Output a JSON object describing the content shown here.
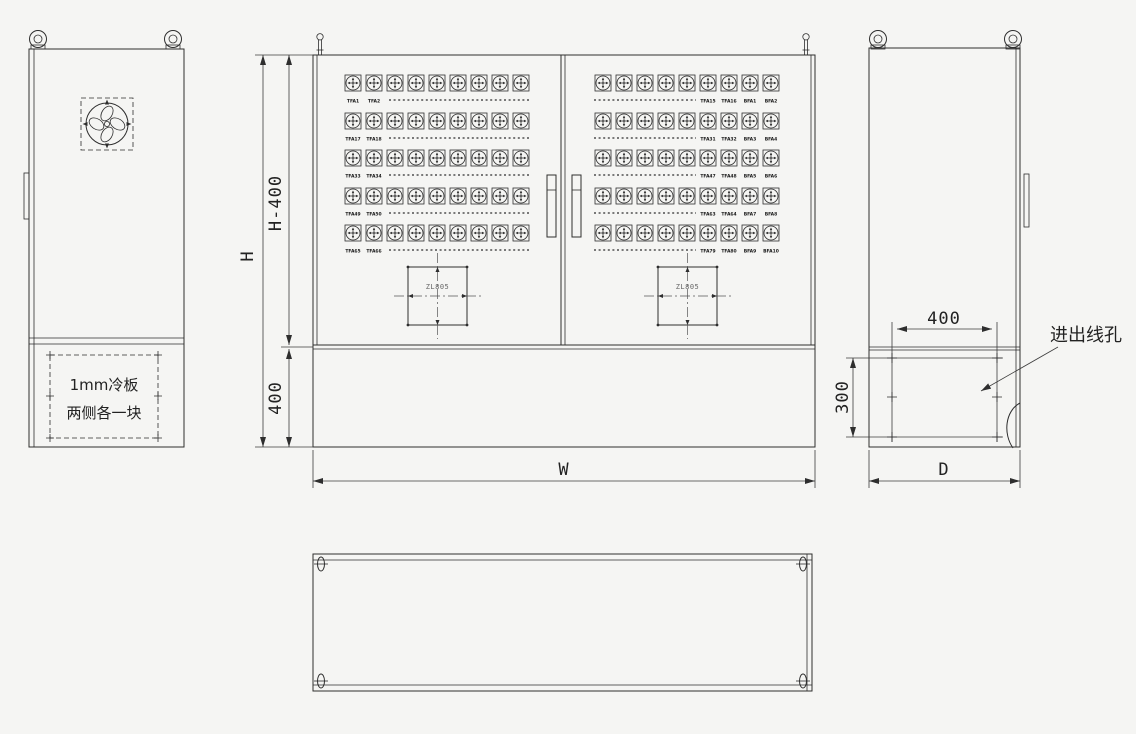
{
  "colors": {
    "background": "#f5f5f3",
    "line": "#2e2e2e",
    "dim_line": "#3c3c3c",
    "muted_text": "#666666"
  },
  "left_view": {
    "cold_plate_note": [
      "1mm冷板",
      "两侧各一块"
    ]
  },
  "front_view": {
    "left_door_rows": [
      [
        "TFA1",
        "TFA2"
      ],
      [
        "TFA17",
        "TFA18"
      ],
      [
        "TFA33",
        "TFA34"
      ],
      [
        "TFA49",
        "TFA50"
      ],
      [
        "TFA65",
        "TFA66"
      ]
    ],
    "right_door_rows": [
      [
        "TFA15",
        "TFA16",
        "BFA1",
        "BFA2"
      ],
      [
        "TFA31",
        "TFA32",
        "BFA3",
        "BFA4"
      ],
      [
        "TFA47",
        "TFA48",
        "BFA5",
        "BFA6"
      ],
      [
        "TFA63",
        "TFA64",
        "BFA7",
        "BFA8"
      ],
      [
        "TFA79",
        "TFA80",
        "BFA9",
        "BFA10"
      ]
    ],
    "cutout_label_left": "ZL805",
    "cutout_label_right": "ZL805",
    "dim_total_height": "H",
    "dim_body_height": "H-400",
    "dim_plinth_height": "400",
    "dim_width": "W"
  },
  "side_view": {
    "dim_hole_width": "400",
    "dim_hole_height": "300",
    "dim_depth": "D",
    "wire_hole_label": "进出线孔"
  }
}
